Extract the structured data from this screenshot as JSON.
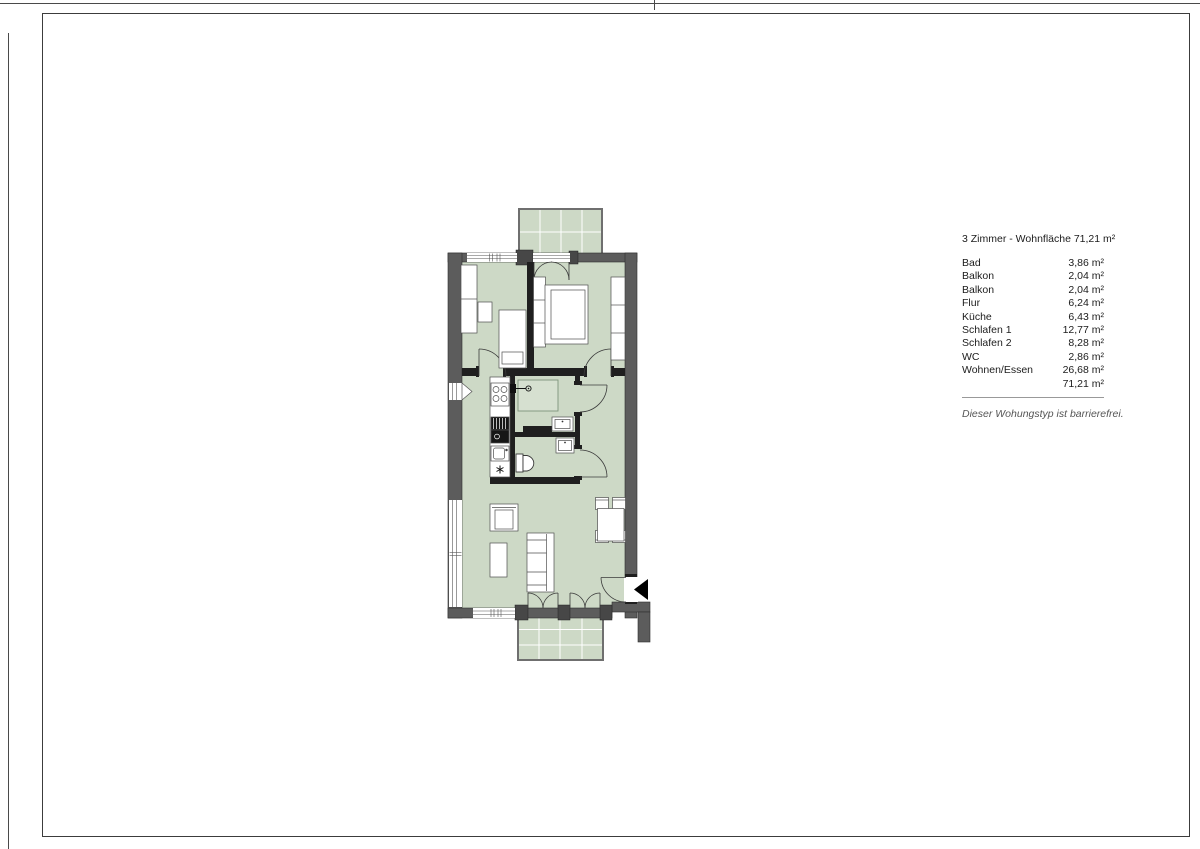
{
  "legend": {
    "title": "3 Zimmer - Wohnfläche 71,21 m²",
    "rows": [
      {
        "label": "Bad",
        "value": "3,86 m²"
      },
      {
        "label": "Balkon",
        "value": "2,04 m²"
      },
      {
        "label": "Balkon",
        "value": "2,04 m²"
      },
      {
        "label": "Flur",
        "value": "6,24 m²"
      },
      {
        "label": "Küche",
        "value": "6,43 m²"
      },
      {
        "label": "Schlafen 1",
        "value": "12,77 m²"
      },
      {
        "label": "Schlafen 2",
        "value": "8,28 m²"
      },
      {
        "label": "WC",
        "value": "2,86 m²"
      },
      {
        "label": "Wohnen/Essen",
        "value": "26,68 m²"
      }
    ],
    "total": "71,21 m²",
    "note": "Dieser Wohungstyp ist barrierefrei."
  },
  "icons": {
    "entrance_arrow": "◀",
    "freezer_star": "✳"
  },
  "colors": {
    "floor_green": "#cdd9c6",
    "shower_green": "#d6e0d0",
    "exterior_wall": "#5c5c5c",
    "interior_wall": "#1f1f1f",
    "balcony_border": "#6f6f6f",
    "text": "#1c1c1c",
    "note_text": "#555555"
  }
}
